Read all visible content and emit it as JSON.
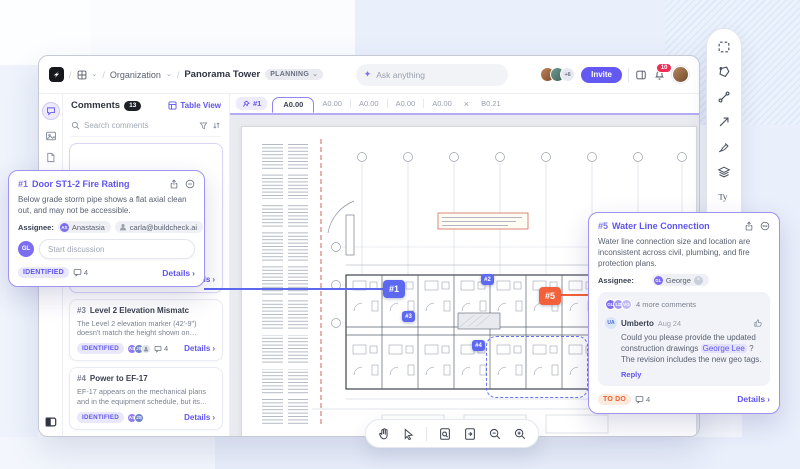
{
  "icons": {
    "chevron_down": "⌄",
    "chevron_right": "›",
    "close": "×",
    "sep": "/",
    "sparkle": "✦",
    "text_tool": "Ty",
    "remove": "×"
  },
  "topbar": {
    "org": "Organization",
    "project": "Panorama Tower",
    "status": "PLANNING",
    "ask_placeholder": "Ask anything",
    "avatar_more": "+6",
    "invite": "Invite",
    "notif_count": "10"
  },
  "tabs": {
    "pinned": "#1",
    "active": "A0.00",
    "others": [
      "A0.00",
      "A0.00",
      "A0.00",
      "A0.00"
    ],
    "last": "B0.21"
  },
  "panel": {
    "title": "Comments",
    "count": "13",
    "table_view": "Table View",
    "search_placeholder": "Search comments",
    "item0": {
      "status": "IDENTIFIED",
      "a1": "AS",
      "a2": "JS",
      "count": "22",
      "details": "Details"
    },
    "item3": {
      "id": "#3",
      "title": "Level 2 Elevation Mismatc",
      "body": "The Level 2 elevation marker (42'-9\") doesn't match the height shown on exterior elevations (4...",
      "status": "IDENTIFIED",
      "a1": "AS",
      "a2": "JS",
      "count": "4",
      "details": "Details"
    },
    "item4": {
      "id": "#4",
      "title": "Power to EF-17",
      "body": "EF-17 appears on the mechanical plans and in the equipment schedule, but its power connection is...",
      "status": "IDENTIFIED",
      "a1": "AS",
      "a2": "JS",
      "details": "Details"
    }
  },
  "popup1": {
    "id": "#1",
    "title": "Door ST1-2 Fire Rating",
    "body": "Below grade storm pipe shows a flat axial clean out, and may not be accessible.",
    "assignee_label": "Assignee:",
    "a1_initials": "AS",
    "a1_name": "Anastasia",
    "a2_name": "carla@buildcheck.ai",
    "composer_initials": "GL",
    "composer_placeholder": "Start discussion",
    "status": "IDENTIFIED",
    "count": "4",
    "details": "Details"
  },
  "card5": {
    "id": "#5",
    "title": "Water Line Connection",
    "body": "Water line connection size and location are inconsistent across civil, plumbing, and fire protection plans.",
    "assignee_label": "Assignee:",
    "assignee_initials": "GL",
    "assignee_name": "George",
    "stack": [
      "GL",
      "LD",
      "VG"
    ],
    "more_comments": "4 more comments",
    "comment_initials": "UA",
    "comment_author": "Umberto",
    "comment_date": "Aug 24",
    "comment_before": "Could you please  provide the updated construction drawings ",
    "comment_mention": "George Lee",
    "comment_after": " ? The revision includes the new geo tags.",
    "reply": "Reply",
    "status": "TO DO",
    "count": "4",
    "details": "Details"
  },
  "markers": {
    "m1": "#1",
    "m2": "#2",
    "m3": "#3",
    "m4": "#4",
    "m5": "#5"
  },
  "colors": {
    "accent": "#5f55ee",
    "marker_blue": "#5b68ef",
    "marker_orange": "#f2613a",
    "identified_bg": "#e9e7fc",
    "todo_text": "#e8622e",
    "notif_red": "#ef2d56"
  }
}
